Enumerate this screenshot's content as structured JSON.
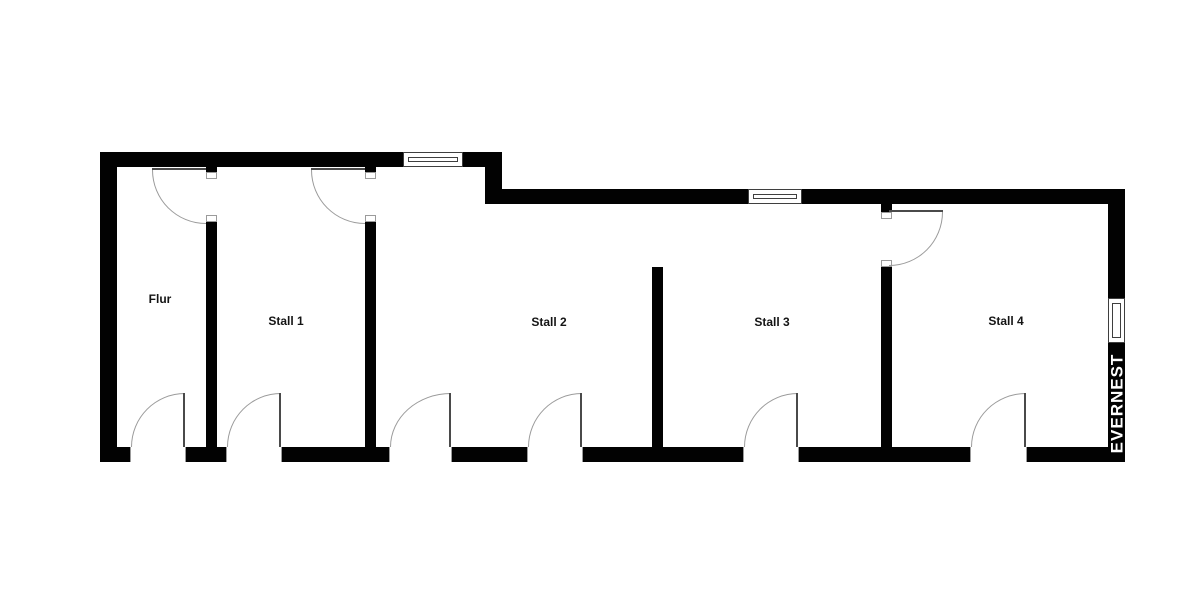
{
  "colors": {
    "background": "#ffffff",
    "wall": "#020202",
    "arc": "#9b9b9b",
    "leaf": "#4a4a4a",
    "frame": "#3f3f3f",
    "jamb": "#9b9b9b",
    "label": "#141414",
    "watermark": "#ffffff"
  },
  "rooms": [
    {
      "label": "Flur"
    },
    {
      "label": "Stall 1"
    },
    {
      "label": "Stall 2"
    },
    {
      "label": "Stall 3"
    },
    {
      "label": "Stall 4"
    }
  ],
  "watermark": {
    "text": "EVERNEST"
  }
}
